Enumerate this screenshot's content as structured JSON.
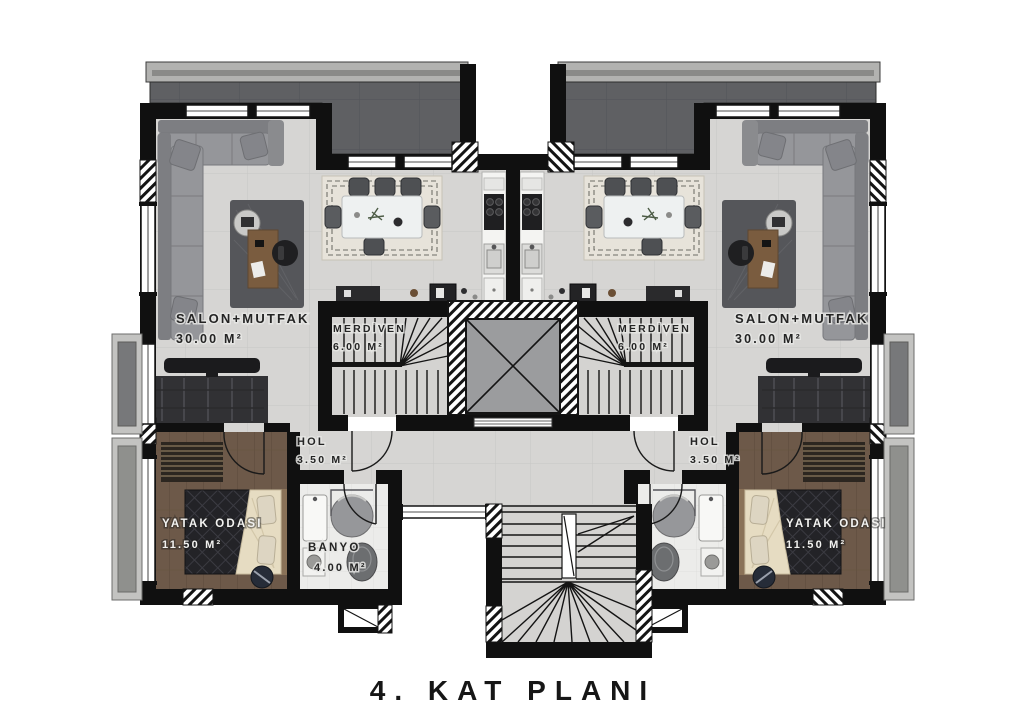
{
  "title": "4. KAT PLANI",
  "rooms": {
    "salon": {
      "name": "SALON+MUTFAK",
      "area": "30.00 M²"
    },
    "merdiven": {
      "name": "MERDİVEN",
      "area": "6.00 M²"
    },
    "hol": {
      "name": "HOL",
      "area": "3.50 M²"
    },
    "yatak_odasi": {
      "name": "YATAK ODASI",
      "area": "11.50 M²"
    },
    "banyo": {
      "name": "BANYO",
      "area": "4.00 M²"
    }
  },
  "colors": {
    "wall": "#101010",
    "floor_tile": "#d6d5d3",
    "terrace": "#5f6063",
    "wood_floor": "#6d5949",
    "bath_floor": "#ececea",
    "fixture_gray": "#96979a",
    "label_dark": "#242424",
    "label_light": "#f2f2f0"
  }
}
